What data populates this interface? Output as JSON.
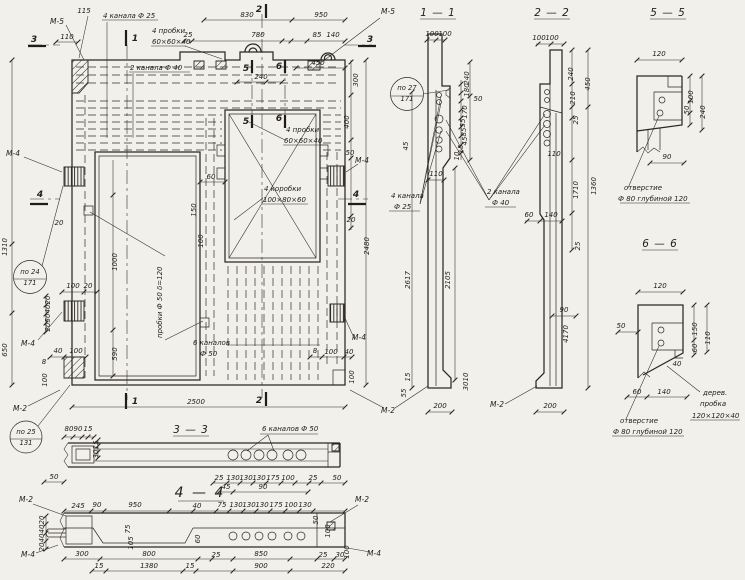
{
  "colors": {
    "paper": "#f2f0ea",
    "ink": "#2b2822"
  },
  "labels": [
    {
      "t": "115",
      "x": 84,
      "y": 13
    },
    {
      "t": "М-5",
      "x": 57,
      "y": 24,
      "k": "marker"
    },
    {
      "t": "110",
      "x": 67,
      "y": 39
    },
    {
      "t": "3",
      "x": 34,
      "y": 42,
      "k": "cut"
    },
    {
      "t": "4 канала Ф 25",
      "x": 103,
      "y": 18,
      "k": "ann"
    },
    {
      "t": "4 пробки",
      "x": 152,
      "y": 33,
      "k": "ann"
    },
    {
      "t": "60×60×40",
      "x": 152,
      "y": 44,
      "k": "ann"
    },
    {
      "t": "2 канала Ф 40",
      "x": 130,
      "y": 70,
      "k": "ann"
    },
    {
      "t": "830",
      "x": 247,
      "y": 17
    },
    {
      "t": "950",
      "x": 321,
      "y": 17
    },
    {
      "t": "2",
      "x": 259,
      "y": 12,
      "k": "cut"
    },
    {
      "t": "1",
      "x": 135,
      "y": 41,
      "k": "cut"
    },
    {
      "t": "25",
      "x": 188,
      "y": 37
    },
    {
      "t": "780",
      "x": 258,
      "y": 37
    },
    {
      "t": "85",
      "x": 317,
      "y": 37
    },
    {
      "t": "140",
      "x": 333,
      "y": 37
    },
    {
      "t": "М-5",
      "x": 388,
      "y": 14,
      "k": "marker"
    },
    {
      "t": "3",
      "x": 370,
      "y": 42,
      "k": "cut"
    },
    {
      "t": "240",
      "x": 261,
      "y": 79
    },
    {
      "t": "450",
      "x": 318,
      "y": 65
    },
    {
      "t": "5",
      "x": 246,
      "y": 71,
      "k": "cut"
    },
    {
      "t": "6",
      "x": 279,
      "y": 69,
      "k": "cut"
    },
    {
      "t": "5",
      "x": 246,
      "y": 124,
      "k": "cut"
    },
    {
      "t": "6",
      "x": 279,
      "y": 121,
      "k": "cut"
    },
    {
      "t": "300",
      "x": 358,
      "y": 80,
      "r": -90
    },
    {
      "t": "400",
      "x": 349,
      "y": 122,
      "r": -90
    },
    {
      "t": "50",
      "x": 350,
      "y": 155
    },
    {
      "t": "М-4",
      "x": 362,
      "y": 163,
      "k": "marker"
    },
    {
      "t": "4",
      "x": 356,
      "y": 197,
      "k": "cut"
    },
    {
      "t": "20",
      "x": 351,
      "y": 222
    },
    {
      "t": "2480",
      "x": 369,
      "y": 246,
      "r": -90
    },
    {
      "t": "М-4",
      "x": 359,
      "y": 340,
      "k": "marker"
    },
    {
      "t": "60",
      "x": 211,
      "y": 179
    },
    {
      "t": "150",
      "x": 196,
      "y": 210,
      "r": -90,
      "s": 6
    },
    {
      "t": "100",
      "x": 203,
      "y": 241,
      "r": -90,
      "s": 6
    },
    {
      "t": "4 пробки",
      "x": 286,
      "y": 132,
      "k": "ann"
    },
    {
      "t": "60×60×40",
      "x": 284,
      "y": 143,
      "k": "ann"
    },
    {
      "t": "4 коробки",
      "x": 264,
      "y": 191,
      "k": "ann"
    },
    {
      "t": "100×80×60",
      "x": 263,
      "y": 202,
      "k": "ann"
    },
    {
      "t": "1310",
      "x": 7,
      "y": 247,
      "r": -90
    },
    {
      "t": "М-4",
      "x": 13,
      "y": 156,
      "k": "marker"
    },
    {
      "t": "4",
      "x": 40,
      "y": 197,
      "k": "cut"
    },
    {
      "t": "по 24",
      "x": 30,
      "y": 274,
      "k": "callout"
    },
    {
      "t": "171",
      "x": 30,
      "y": 285,
      "k": "callout"
    },
    {
      "t": "20",
      "x": 59,
      "y": 225
    },
    {
      "t": "пробки Ф 50  δ=120",
      "x": 162,
      "y": 338,
      "r": -90,
      "k": "ann"
    },
    {
      "t": "100",
      "x": 73,
      "y": 288,
      "s": 6
    },
    {
      "t": "20",
      "x": 88,
      "y": 288,
      "s": 6
    },
    {
      "t": "20",
      "x": 50,
      "y": 300,
      "r": -90,
      "s": 5.5
    },
    {
      "t": "40",
      "x": 50,
      "y": 309,
      "r": -90,
      "s": 5.5
    },
    {
      "t": "50",
      "x": 50,
      "y": 318,
      "r": -90,
      "s": 5.5
    },
    {
      "t": "20",
      "x": 50,
      "y": 327,
      "r": -90,
      "s": 5.5
    },
    {
      "t": "М-4",
      "x": 28,
      "y": 346,
      "k": "marker"
    },
    {
      "t": "650",
      "x": 7,
      "y": 350,
      "r": -90
    },
    {
      "t": "1000",
      "x": 117,
      "y": 262,
      "r": -90
    },
    {
      "t": "590",
      "x": 117,
      "y": 354,
      "r": -90
    },
    {
      "t": "40",
      "x": 58,
      "y": 353,
      "s": 6
    },
    {
      "t": "100",
      "x": 76,
      "y": 353,
      "s": 6
    },
    {
      "t": "8",
      "x": 44,
      "y": 364,
      "s": 6
    },
    {
      "t": "100",
      "x": 47,
      "y": 380,
      "r": -90,
      "s": 5.5
    },
    {
      "t": "М-2",
      "x": 20,
      "y": 411,
      "k": "marker"
    },
    {
      "t": "по 25",
      "x": 26,
      "y": 434,
      "k": "callout"
    },
    {
      "t": "131",
      "x": 26,
      "y": 445,
      "k": "callout"
    },
    {
      "t": "6 каналов",
      "x": 193,
      "y": 345,
      "k": "ann"
    },
    {
      "t": "Ф 50",
      "x": 200,
      "y": 356,
      "k": "ann"
    },
    {
      "t": "8",
      "x": 315,
      "y": 353,
      "s": 6
    },
    {
      "t": "100",
      "x": 331,
      "y": 354,
      "s": 6
    },
    {
      "t": "40",
      "x": 349,
      "y": 354,
      "s": 6
    },
    {
      "t": "100",
      "x": 354,
      "y": 377,
      "r": -90,
      "s": 5.5
    },
    {
      "t": "2",
      "x": 259,
      "y": 403,
      "k": "cut"
    },
    {
      "t": "1",
      "x": 135,
      "y": 404,
      "k": "cut"
    },
    {
      "t": "2500",
      "x": 196,
      "y": 404
    },
    {
      "t": "М-2",
      "x": 388,
      "y": 413,
      "k": "marker"
    },
    {
      "t": "1 — 1",
      "x": 438,
      "y": 16,
      "k": "title"
    },
    {
      "t": "по 27",
      "x": 407,
      "y": 90,
      "k": "callout"
    },
    {
      "t": "171",
      "x": 407,
      "y": 101,
      "k": "callout"
    },
    {
      "t": "100",
      "x": 432,
      "y": 36,
      "s": 6
    },
    {
      "t": "100",
      "x": 445,
      "y": 36,
      "s": 6
    },
    {
      "t": "240",
      "x": 469,
      "y": 78,
      "r": -90,
      "s": 5.5
    },
    {
      "t": "180",
      "x": 469,
      "y": 90,
      "r": -90,
      "s": 5.5
    },
    {
      "t": "50",
      "x": 478,
      "y": 101,
      "s": 5.5
    },
    {
      "t": "170",
      "x": 467,
      "y": 112,
      "r": -90,
      "s": 5.5
    },
    {
      "t": "55",
      "x": 465,
      "y": 123,
      "r": -90,
      "s": 5.5
    },
    {
      "t": "85",
      "x": 466,
      "y": 132,
      "r": -90,
      "s": 5.5
    },
    {
      "t": "45",
      "x": 467,
      "y": 141,
      "r": -90,
      "s": 5.5
    },
    {
      "t": "15",
      "x": 463,
      "y": 149,
      "r": -90,
      "s": 5.5
    },
    {
      "t": "10",
      "x": 459,
      "y": 156,
      "r": -90,
      "s": 5.5
    },
    {
      "t": "45",
      "x": 408,
      "y": 146,
      "r": -90,
      "s": 5.5
    },
    {
      "t": "110",
      "x": 436,
      "y": 176,
      "s": 6
    },
    {
      "t": "4 канала",
      "x": 391,
      "y": 198,
      "k": "ann"
    },
    {
      "t": "Ф 25",
      "x": 394,
      "y": 209,
      "k": "ann"
    },
    {
      "t": "2 канала",
      "x": 487,
      "y": 194,
      "k": "ann"
    },
    {
      "t": "Ф 40",
      "x": 492,
      "y": 205,
      "k": "ann"
    },
    {
      "t": "2617",
      "x": 410,
      "y": 280,
      "r": -90
    },
    {
      "t": "2105",
      "x": 450,
      "y": 280,
      "r": -90
    },
    {
      "t": "15",
      "x": 410,
      "y": 377,
      "r": -90,
      "s": 5.5
    },
    {
      "t": "55",
      "x": 406,
      "y": 393,
      "r": -90,
      "s": 5.5
    },
    {
      "t": "10",
      "x": 468,
      "y": 377,
      "r": -90,
      "s": 5.5
    },
    {
      "t": "30",
      "x": 468,
      "y": 386,
      "r": -90,
      "s": 5.5
    },
    {
      "t": "200",
      "x": 440,
      "y": 408
    },
    {
      "t": "2 — 2",
      "x": 552,
      "y": 16,
      "k": "title"
    },
    {
      "t": "100",
      "x": 539,
      "y": 40,
      "s": 6
    },
    {
      "t": "100",
      "x": 552,
      "y": 40,
      "s": 6
    },
    {
      "t": "240",
      "x": 573,
      "y": 74,
      "r": -90,
      "s": 5.5
    },
    {
      "t": "450",
      "x": 590,
      "y": 84,
      "r": -90
    },
    {
      "t": "210",
      "x": 575,
      "y": 98,
      "r": -90,
      "s": 5.5
    },
    {
      "t": "25",
      "x": 578,
      "y": 120,
      "r": -90,
      "s": 5.5
    },
    {
      "t": "110",
      "x": 554,
      "y": 156,
      "s": 6
    },
    {
      "t": "1710",
      "x": 578,
      "y": 190,
      "r": -90
    },
    {
      "t": "1360",
      "x": 596,
      "y": 186,
      "r": -90
    },
    {
      "t": "60",
      "x": 529,
      "y": 217,
      "s": 6
    },
    {
      "t": "140",
      "x": 551,
      "y": 217,
      "s": 6
    },
    {
      "t": "25",
      "x": 580,
      "y": 246,
      "r": -90,
      "s": 5.5
    },
    {
      "t": "90",
      "x": 564,
      "y": 312,
      "s": 6
    },
    {
      "t": "4170",
      "x": 568,
      "y": 334,
      "r": -90
    },
    {
      "t": "200",
      "x": 550,
      "y": 408
    },
    {
      "t": "М-2",
      "x": 497,
      "y": 407,
      "k": "marker"
    },
    {
      "t": "5 — 5",
      "x": 668,
      "y": 16,
      "k": "title"
    },
    {
      "t": "120",
      "x": 659,
      "y": 56
    },
    {
      "t": "100",
      "x": 693,
      "y": 97,
      "r": -90,
      "s": 5.5
    },
    {
      "t": "50",
      "x": 689,
      "y": 110,
      "r": -90,
      "s": 5.5
    },
    {
      "t": "240",
      "x": 705,
      "y": 112,
      "r": -90
    },
    {
      "t": "90",
      "x": 667,
      "y": 159
    },
    {
      "t": "отверстие",
      "x": 624,
      "y": 190,
      "k": "ann"
    },
    {
      "t": "Ф 80 глубиной 120",
      "x": 618,
      "y": 201,
      "k": "ann"
    },
    {
      "t": "6 — 6",
      "x": 660,
      "y": 247,
      "k": "title"
    },
    {
      "t": "120",
      "x": 660,
      "y": 288
    },
    {
      "t": "50",
      "x": 621,
      "y": 328
    },
    {
      "t": "150",
      "x": 697,
      "y": 329,
      "r": -90,
      "s": 5.5
    },
    {
      "t": "60",
      "x": 697,
      "y": 348,
      "r": -90,
      "s": 5.5
    },
    {
      "t": "110",
      "x": 710,
      "y": 338,
      "r": -90
    },
    {
      "t": "40",
      "x": 677,
      "y": 366,
      "s": 6
    },
    {
      "t": "60",
      "x": 637,
      "y": 394,
      "s": 6
    },
    {
      "t": "140",
      "x": 664,
      "y": 394,
      "s": 6
    },
    {
      "t": "дерев.",
      "x": 703,
      "y": 395,
      "k": "ann"
    },
    {
      "t": "пробка",
      "x": 700,
      "y": 406,
      "k": "ann"
    },
    {
      "t": "120×120×40",
      "x": 692,
      "y": 418,
      "k": "ann"
    },
    {
      "t": "отверстие",
      "x": 620,
      "y": 423,
      "k": "ann"
    },
    {
      "t": "Ф 80 глубиной 120",
      "x": 613,
      "y": 434,
      "k": "ann"
    },
    {
      "t": "3 — 3",
      "x": 191,
      "y": 433,
      "k": "title"
    },
    {
      "t": "80",
      "x": 69,
      "y": 431,
      "s": 6
    },
    {
      "t": "90",
      "x": 78,
      "y": 431,
      "s": 6
    },
    {
      "t": "15",
      "x": 88,
      "y": 431,
      "s": 6
    },
    {
      "t": "15",
      "x": 98,
      "y": 445,
      "r": -90,
      "s": 5.5
    },
    {
      "t": "30",
      "x": 98,
      "y": 454,
      "r": -90,
      "s": 5.5
    },
    {
      "t": "6 каналов Ф 50",
      "x": 262,
      "y": 431,
      "k": "ann"
    },
    {
      "t": "50",
      "x": 54,
      "y": 479
    },
    {
      "t": "25",
      "x": 219,
      "y": 480,
      "s": 6
    },
    {
      "t": "130",
      "x": 233,
      "y": 480,
      "s": 6
    },
    {
      "t": "130",
      "x": 246,
      "y": 480,
      "s": 6
    },
    {
      "t": "130",
      "x": 259,
      "y": 480,
      "s": 6
    },
    {
      "t": "175",
      "x": 273,
      "y": 480,
      "s": 6
    },
    {
      "t": "100",
      "x": 288,
      "y": 480,
      "s": 6
    },
    {
      "t": "25",
      "x": 313,
      "y": 480,
      "s": 6
    },
    {
      "t": "50",
      "x": 337,
      "y": 480,
      "s": 6
    },
    {
      "t": "45",
      "x": 226,
      "y": 489,
      "s": 6
    },
    {
      "t": "90",
      "x": 263,
      "y": 489,
      "s": 6
    },
    {
      "t": "4 — 4",
      "x": 200,
      "y": 497,
      "k": "big"
    },
    {
      "t": "М-2",
      "x": 26,
      "y": 502,
      "k": "marker"
    },
    {
      "t": "М-2",
      "x": 362,
      "y": 502,
      "k": "marker"
    },
    {
      "t": "245",
      "x": 78,
      "y": 508,
      "s": 6
    },
    {
      "t": "90",
      "x": 97,
      "y": 507,
      "s": 6
    },
    {
      "t": "950",
      "x": 135,
      "y": 507,
      "s": 6
    },
    {
      "t": "40",
      "x": 197,
      "y": 508,
      "s": 6
    },
    {
      "t": "75",
      "x": 222,
      "y": 507,
      "s": 6
    },
    {
      "t": "130",
      "x": 236,
      "y": 507,
      "s": 6
    },
    {
      "t": "130",
      "x": 249,
      "y": 507,
      "s": 6
    },
    {
      "t": "130",
      "x": 262,
      "y": 507,
      "s": 6
    },
    {
      "t": "175",
      "x": 276,
      "y": 507,
      "s": 6
    },
    {
      "t": "100",
      "x": 291,
      "y": 507,
      "s": 6
    },
    {
      "t": "130",
      "x": 305,
      "y": 507,
      "s": 6
    },
    {
      "t": "20",
      "x": 44,
      "y": 520,
      "r": -90,
      "s": 5.5
    },
    {
      "t": "40",
      "x": 44,
      "y": 529,
      "r": -90,
      "s": 5.5
    },
    {
      "t": "40",
      "x": 44,
      "y": 538,
      "r": -90,
      "s": 5.5
    },
    {
      "t": "20",
      "x": 44,
      "y": 547,
      "r": -90,
      "s": 5.5
    },
    {
      "t": "75",
      "x": 130,
      "y": 529,
      "r": -90,
      "s": 5.5
    },
    {
      "t": "105",
      "x": 133,
      "y": 543,
      "r": -90,
      "s": 5.5
    },
    {
      "t": "60",
      "x": 200,
      "y": 539,
      "r": -90,
      "s": 5.5
    },
    {
      "t": "50",
      "x": 318,
      "y": 520,
      "r": -90,
      "s": 5.5
    },
    {
      "t": "100",
      "x": 330,
      "y": 531,
      "r": -90,
      "s": 5.5
    },
    {
      "t": "М-4",
      "x": 28,
      "y": 557,
      "k": "marker"
    },
    {
      "t": "300",
      "x": 82,
      "y": 556,
      "s": 6
    },
    {
      "t": "800",
      "x": 149,
      "y": 556,
      "s": 6
    },
    {
      "t": "25",
      "x": 216,
      "y": 557,
      "s": 6
    },
    {
      "t": "850",
      "x": 261,
      "y": 556,
      "s": 6
    },
    {
      "t": "25",
      "x": 323,
      "y": 557,
      "s": 6
    },
    {
      "t": "30",
      "x": 340,
      "y": 557,
      "s": 6
    },
    {
      "t": "15",
      "x": 99,
      "y": 568,
      "s": 6
    },
    {
      "t": "1380",
      "x": 149,
      "y": 568,
      "s": 6
    },
    {
      "t": "15",
      "x": 190,
      "y": 568,
      "s": 6
    },
    {
      "t": "900",
      "x": 261,
      "y": 568,
      "s": 6
    },
    {
      "t": "220",
      "x": 328,
      "y": 568,
      "s": 6
    },
    {
      "t": "100",
      "x": 349,
      "y": 552,
      "r": -90,
      "s": 5.5
    },
    {
      "t": "М-4",
      "x": 374,
      "y": 556,
      "k": "marker"
    }
  ]
}
